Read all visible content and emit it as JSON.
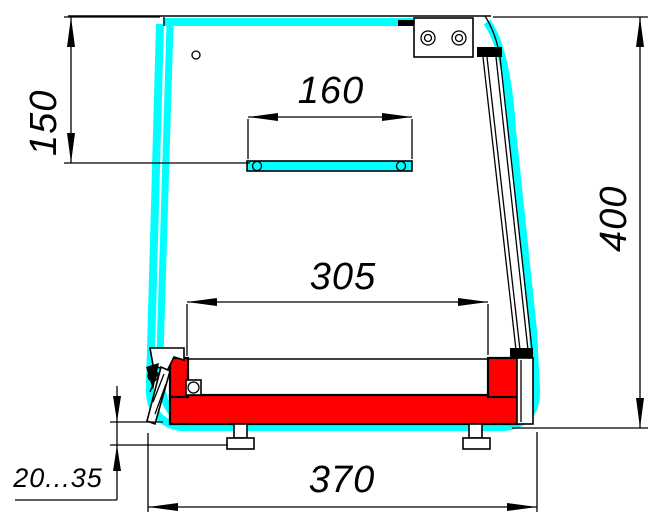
{
  "drawing": {
    "title": "Counter display case cross-section",
    "colors": {
      "contour_highlight": "#00ffff",
      "heated_base_fill": "#ff0000",
      "line": "#000000",
      "background": "#ffffff"
    },
    "dimensions": {
      "front_panel_height": "150",
      "upper_shelf_width": "160",
      "well_inner_width": "305",
      "overall_height": "400",
      "overall_depth": "370",
      "leg_adjustment_range": "20...35"
    }
  }
}
